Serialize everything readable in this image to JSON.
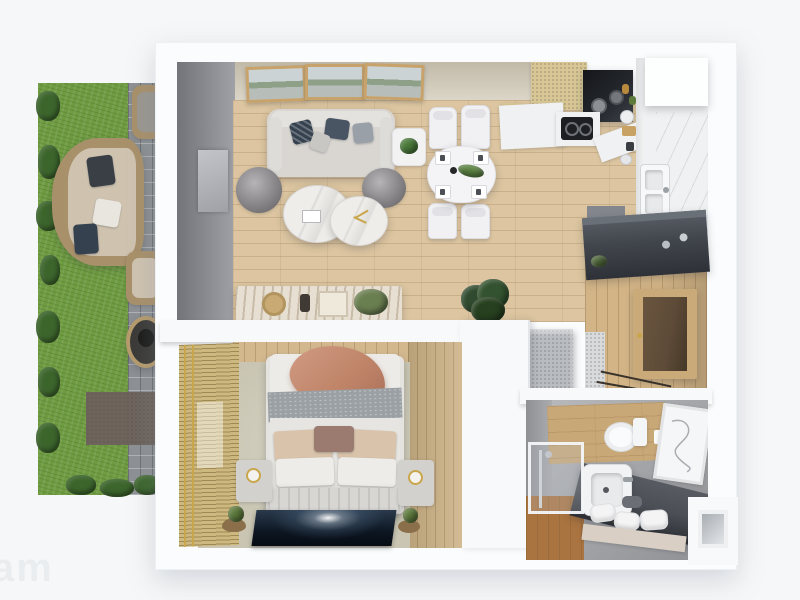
{
  "meta": {
    "render_type": "3d-top-down-apartment-floor-plan",
    "watermark_fragment": "am"
  },
  "palette": {
    "page_bg": "#f6f7f8",
    "watermark_color": "#eaedf0",
    "wall_white": "#fbfcfd",
    "grass": "#6f9c42",
    "hedge": "#3c652c",
    "path_tile": "#8d9194",
    "patio": "#6e645c",
    "wicker": "#a8906a",
    "cushion": "#cfc3b0",
    "beige_wall": "#d7d0c0",
    "curtain_gray": "#93949a",
    "wood_floor": "#dcc5a0",
    "hall_wood": "#d2b486",
    "wood_wall": "#d3b88e",
    "bath_wood": "#aa7440",
    "bed_floor": "#c9c5b2",
    "bamboo": "#cdb87f",
    "sofa_gray": "#d9d6d2",
    "pouf_gray": "#8f8c90",
    "navy_pillow": "#35414f",
    "terracotta": "#c08569",
    "marble": "#efede9",
    "counter_white": "#eff1f2",
    "kitchen_cabinet": "#d8c694",
    "appliance_dark": "#24272c",
    "dark_console": "#41454c",
    "door_brown": "#5d4a37",
    "door_frame": "#c9aa78",
    "vanity_dark": "#4b4f55",
    "plant_green": "#3a5c33",
    "gold": "#c9a64c"
  },
  "scene": {
    "rooms": [
      {
        "name": "garden-terrace",
        "items": [
          "lawn",
          "hedges",
          "paved-path",
          "outdoor-wicker-sofa",
          "wicker-chairs",
          "fire-pit",
          "patio-mat"
        ]
      },
      {
        "name": "living-room",
        "items": [
          "wall-art-triptych",
          "sofa-with-pillows",
          "two-poufs",
          "round-marble-coffee-tables",
          "side-table-with-plant",
          "curtain-wall",
          "tv-panel",
          "sideboard",
          "large-potted-plant"
        ]
      },
      {
        "name": "dining-area",
        "items": [
          "oval-white-table",
          "four-chairs",
          "four-place-settings",
          "centerpiece-plant",
          "pepper-mill"
        ]
      },
      {
        "name": "kitchen",
        "items": [
          "tall-wood-cabinet",
          "dark-cooktop-hood-unit",
          "white-counters",
          "gas-stove",
          "double-sink",
          "fridge-column",
          "counter-items"
        ]
      },
      {
        "name": "hallway",
        "items": [
          "dark-console",
          "entry-door",
          "speckled-bench",
          "wood-floor"
        ]
      },
      {
        "name": "bedroom",
        "items": [
          "double-bed",
          "terracotta-throw",
          "pillows",
          "foot-bench",
          "two-nightstands",
          "lamps",
          "night-photo-rug",
          "bamboo-blinds",
          "small-plants",
          "wood-clad-walls"
        ]
      },
      {
        "name": "bathroom",
        "items": [
          "wall-hung-toilet",
          "dark-vanity",
          "white-sink",
          "glass-shower",
          "towels",
          "shelf",
          "wall-art",
          "wood-floor-strip"
        ]
      }
    ]
  }
}
